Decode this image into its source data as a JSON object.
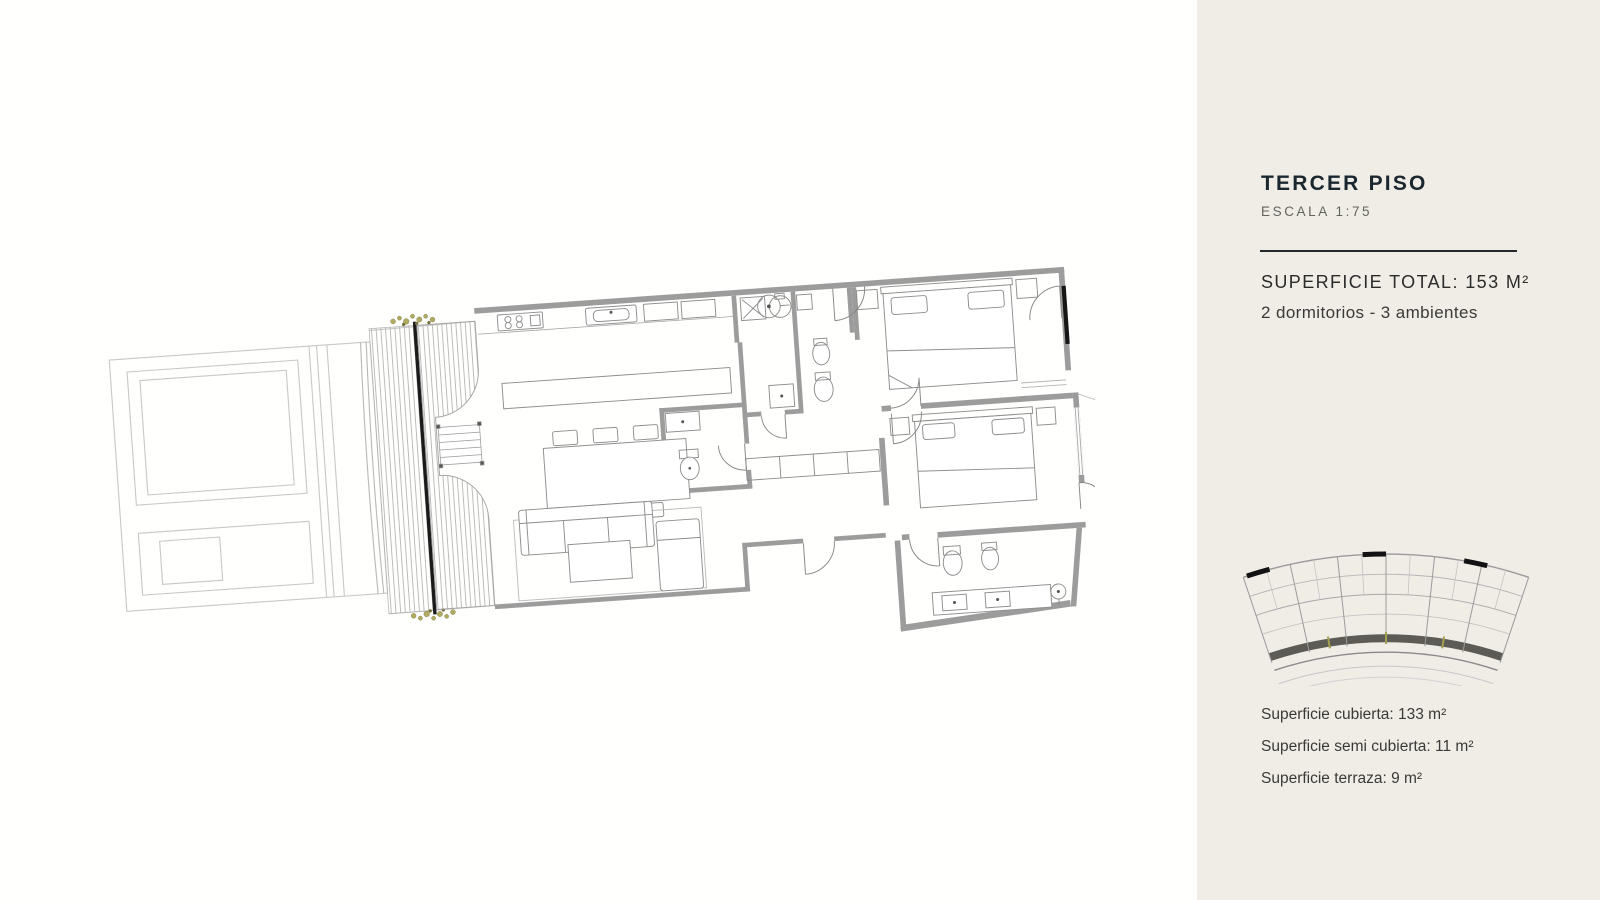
{
  "page": {
    "background": "#ffffff"
  },
  "panel": {
    "background": "#f0ede7",
    "title": "TERCER PISO",
    "title_color": "#1a272f",
    "scale": "ESCALA 1:75",
    "superficie_total": "SUPERFICIE TOTAL: 153 M²",
    "tipologia": "2 dormitorios - 3 ambientes",
    "areas": [
      "Superficie cubierta: 133 m²",
      "Superficie semi cubierta: 11 m²",
      "Superficie terraza: 9 m²"
    ]
  },
  "floor_plan": {
    "name": "tercer-piso-apartment-plan",
    "rooms": [
      "kitchen",
      "dining",
      "living",
      "bedroom-1",
      "bedroom-2",
      "bathroom",
      "ensuite-bathroom",
      "laundry",
      "deck-terrace"
    ],
    "colors": {
      "walls": "#9c9c9c",
      "furniture_line": "#8d8d8d",
      "context_line": "#c9c9c9",
      "facade_black": "#1a1a1a",
      "plants_olive": "#a9a45e",
      "mini_balcony_dark": "#5d5b55"
    }
  }
}
